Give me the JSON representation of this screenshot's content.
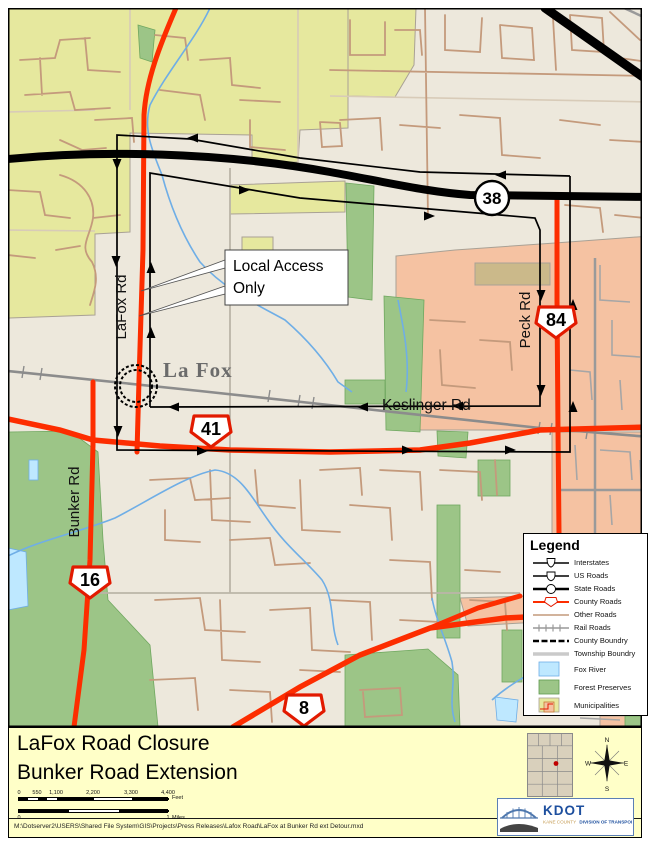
{
  "title_block": {
    "line1": "LaFox Road Closure",
    "line2": "Bunker Road Extension"
  },
  "map": {
    "town_label": "La Fox",
    "road_labels": {
      "lafox": "LaFox Rd",
      "peck": "Peck Rd",
      "bunker": "Bunker Rd",
      "keslinger": "Keslinger Rd"
    },
    "callout": {
      "line1": "Local Access",
      "line2": "Only"
    },
    "shields": {
      "r38": "38",
      "r84": "84",
      "r41": "41",
      "r16": "16",
      "r8": "8"
    }
  },
  "legend": {
    "title": "Legend",
    "items": [
      {
        "label": "Interstates"
      },
      {
        "label": "US Roads"
      },
      {
        "label": "State Roads"
      },
      {
        "label": "County Roads"
      },
      {
        "label": "Other Roads"
      },
      {
        "label": "Rail Roads"
      },
      {
        "label": "County Boundry"
      },
      {
        "label": "Township Boundry"
      },
      {
        "label": "Fox River"
      },
      {
        "label": "Forest Preserves"
      },
      {
        "label": "Municipalities"
      }
    ]
  },
  "scalebar": {
    "feet_ticks": [
      "0",
      "550",
      "1,100",
      "2,200",
      "3,300",
      "4,400"
    ],
    "feet_unit": "Feet",
    "miles_ticks": [
      "0",
      "1"
    ],
    "miles_unit": "Miles"
  },
  "compass": {
    "n": "N",
    "e": "E",
    "s": "S",
    "w": "W"
  },
  "logo": {
    "acronym": "KDOT",
    "org": "KANE COUNTY",
    "division": "DIVISION OF TRANSPORTATION"
  },
  "footer": {
    "path": "M:\\Dotserver2\\USERS\\Shared File System\\GIS\\Projects\\Press Releases\\Lafox Road\\LaFox at Bunker Rd ext Detour.mxd"
  },
  "colors": {
    "county_road": "#FD2D00",
    "state_road": "#000000",
    "municipality_yellow": "#E6E89E",
    "municipality_salmon": "#F5C2A2",
    "municipality_khaki": "#CBB98A",
    "forest": "#9CC587",
    "water": "#BEE8FF",
    "title_bar": "#FFFFC8"
  }
}
